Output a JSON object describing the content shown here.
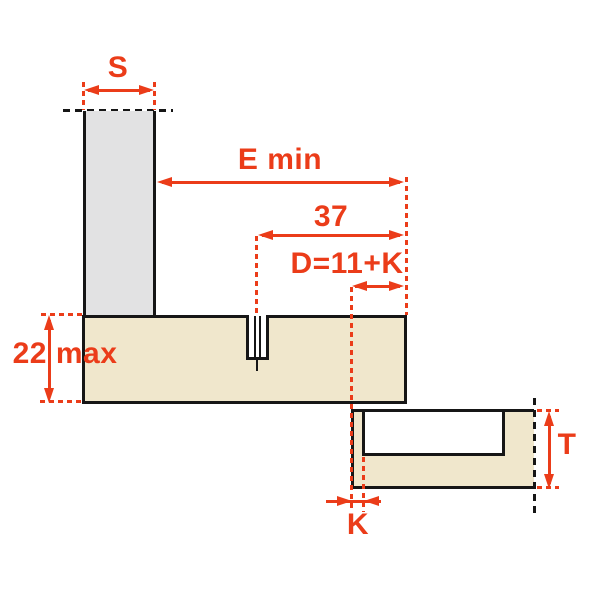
{
  "diagram": {
    "kind": "hinge-mounting-dimension-drawing",
    "labels": {
      "side_panel_thickness": "S",
      "e_min": "E min",
      "hole_distance": "37",
      "d_formula": "D=11+K",
      "board_thickness_max": "22 max",
      "k_overlay": "K",
      "door_thickness": "T"
    },
    "colors": {
      "accent": "#EB3C19",
      "outline": "#161616",
      "side_panel_fill": "#E2E2E3",
      "wood_fill": "#F0E7CC",
      "background": "#FFFFFF"
    }
  }
}
